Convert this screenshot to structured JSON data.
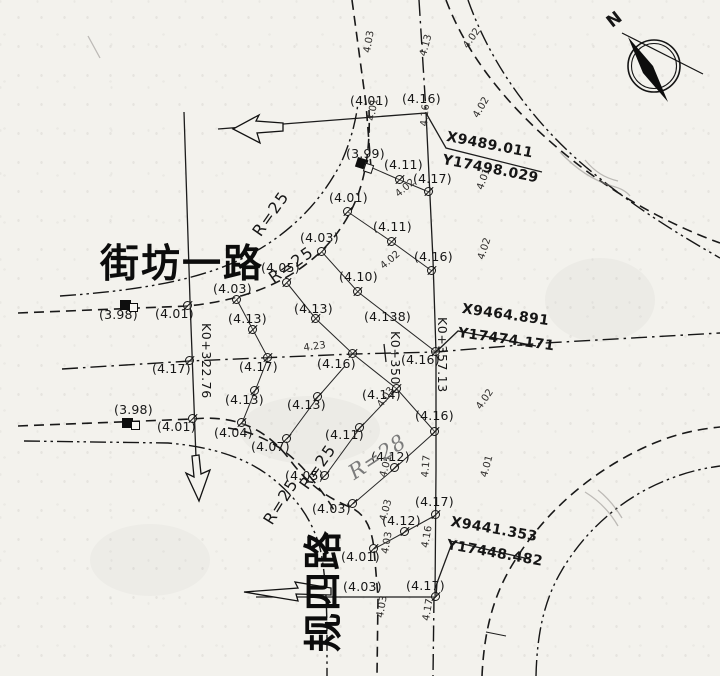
{
  "drawing": {
    "road_names": {
      "horizontal": "街坊一路",
      "vertical": "规四路"
    },
    "compass_label": "N",
    "coordinate_callouts": [
      {
        "x_label": "X9489.011",
        "y_label": "Y17498.029",
        "x": 448,
        "y": 130,
        "x2": 444,
        "y2": 153,
        "r": 11
      },
      {
        "x_label": "X9464.891",
        "y_label": "Y17474.171",
        "x": 463,
        "y": 302,
        "x2": 459,
        "y2": 326,
        "r": 8
      },
      {
        "x_label": "X9441.353",
        "y_label": "Y17448.482",
        "x": 452,
        "y": 515,
        "x2": 448,
        "y2": 538,
        "r": 10
      }
    ],
    "stations": [
      {
        "t": "K0+322.76",
        "x": 212,
        "y": 323,
        "r": 90
      },
      {
        "t": "K0+350",
        "x": 401,
        "y": 331,
        "r": 90
      },
      {
        "t": "K0+357.13",
        "x": 448,
        "y": 317,
        "r": 90
      }
    ],
    "radius_labels": [
      {
        "t": "R=25",
        "x": 250,
        "y": 230,
        "r": -55
      },
      {
        "t": "R=25",
        "x": 266,
        "y": 273,
        "r": -35
      },
      {
        "t": "R=25",
        "x": 297,
        "y": 483,
        "r": -55
      },
      {
        "t": "R=25",
        "x": 261,
        "y": 519,
        "r": -58
      }
    ],
    "pencil_note": {
      "t": "R=28",
      "x": 345,
      "y": 466,
      "r": -33
    },
    "spot_elevations": [
      {
        "t": "(4.01)",
        "x": 350,
        "y": 95
      },
      {
        "t": "(4.16)",
        "x": 402,
        "y": 93
      },
      {
        "t": "(3.99)",
        "x": 346,
        "y": 148
      },
      {
        "t": "(4.11)",
        "x": 384,
        "y": 159
      },
      {
        "t": "(4.17)",
        "x": 413,
        "y": 173
      },
      {
        "t": "(4.01)",
        "x": 329,
        "y": 192
      },
      {
        "t": "(4.11)",
        "x": 373,
        "y": 221
      },
      {
        "t": "(4.03)",
        "x": 300,
        "y": 232
      },
      {
        "t": "(4.16)",
        "x": 414,
        "y": 251
      },
      {
        "t": "(4.10)",
        "x": 339,
        "y": 271
      },
      {
        "t": "(4.05)",
        "x": 261,
        "y": 262
      },
      {
        "t": "(4.03)",
        "x": 213,
        "y": 283
      },
      {
        "t": "(3.98)",
        "x": 99,
        "y": 309
      },
      {
        "t": "(4.01)",
        "x": 155,
        "y": 308
      },
      {
        "t": "(4.13)",
        "x": 228,
        "y": 313
      },
      {
        "t": "(4.13)",
        "x": 294,
        "y": 303
      },
      {
        "t": "(4.138)",
        "x": 364,
        "y": 311
      },
      {
        "t": "(4.17)",
        "x": 152,
        "y": 363
      },
      {
        "t": "(4.17)",
        "x": 239,
        "y": 361
      },
      {
        "t": "(4.16)",
        "x": 317,
        "y": 358
      },
      {
        "t": "(4.16)",
        "x": 401,
        "y": 354
      },
      {
        "t": "(3.98)",
        "x": 114,
        "y": 404
      },
      {
        "t": "(4.01)",
        "x": 157,
        "y": 421
      },
      {
        "t": "(4.13)",
        "x": 225,
        "y": 394
      },
      {
        "t": "(4.13)",
        "x": 287,
        "y": 399
      },
      {
        "t": "(4.14)",
        "x": 362,
        "y": 389
      },
      {
        "t": "(4.04)",
        "x": 214,
        "y": 427
      },
      {
        "t": "(4.07)",
        "x": 251,
        "y": 441
      },
      {
        "t": "(4.11)",
        "x": 325,
        "y": 429
      },
      {
        "t": "(4.16)",
        "x": 415,
        "y": 410
      },
      {
        "t": "(4.05)",
        "x": 285,
        "y": 470
      },
      {
        "t": "(4.12)",
        "x": 371,
        "y": 451
      },
      {
        "t": "(4.12)",
        "x": 382,
        "y": 515
      },
      {
        "t": "(4.17)",
        "x": 415,
        "y": 496
      },
      {
        "t": "(4.03)",
        "x": 312,
        "y": 503
      },
      {
        "t": "(4.01)",
        "x": 341,
        "y": 551
      },
      {
        "t": "(4.03)",
        "x": 343,
        "y": 581
      },
      {
        "t": "(4.17)",
        "x": 406,
        "y": 580
      }
    ],
    "slope_labels": [
      {
        "t": "4.03",
        "x": 363,
        "y": 52,
        "r": -80
      },
      {
        "t": "4.13",
        "x": 419,
        "y": 55,
        "r": -75
      },
      {
        "t": "4.01",
        "x": 367,
        "y": 120,
        "r": -80
      },
      {
        "t": "4.16",
        "x": 420,
        "y": 126,
        "r": -85
      },
      {
        "t": "4.02",
        "x": 462,
        "y": 45,
        "r": -55
      },
      {
        "t": "4.02",
        "x": 472,
        "y": 115,
        "r": -60
      },
      {
        "t": "4.01",
        "x": 476,
        "y": 188,
        "r": -70
      },
      {
        "t": "4.02",
        "x": 394,
        "y": 192,
        "r": -40
      },
      {
        "t": "4.02",
        "x": 379,
        "y": 264,
        "r": -40
      },
      {
        "t": "4.02",
        "x": 477,
        "y": 258,
        "r": -72
      },
      {
        "t": "4.23",
        "x": 303,
        "y": 344,
        "r": -8
      },
      {
        "t": "4.03",
        "x": 376,
        "y": 404,
        "r": -55
      },
      {
        "t": "4.02",
        "x": 475,
        "y": 406,
        "r": -55
      },
      {
        "t": "4.01",
        "x": 379,
        "y": 476,
        "r": -75
      },
      {
        "t": "4.17",
        "x": 421,
        "y": 477,
        "r": -85
      },
      {
        "t": "4.01",
        "x": 480,
        "y": 476,
        "r": -75
      },
      {
        "t": "4.03",
        "x": 379,
        "y": 520,
        "r": -75
      },
      {
        "t": "4.03",
        "x": 381,
        "y": 553,
        "r": -80
      },
      {
        "t": "4.16",
        "x": 421,
        "y": 547,
        "r": -80
      },
      {
        "t": "4.03",
        "x": 376,
        "y": 617,
        "r": -80
      },
      {
        "t": "4.17",
        "x": 422,
        "y": 620,
        "r": -80
      }
    ],
    "survey_points": [
      [
        400,
        180
      ],
      [
        429,
        192
      ],
      [
        348,
        212
      ],
      [
        392,
        242
      ],
      [
        432,
        271
      ],
      [
        322,
        252
      ],
      [
        358,
        292
      ],
      [
        287,
        283
      ],
      [
        237,
        300
      ],
      [
        316,
        319
      ],
      [
        253,
        330
      ],
      [
        188,
        306
      ],
      [
        268,
        358
      ],
      [
        353,
        354
      ],
      [
        190,
        361
      ],
      [
        436,
        352
      ],
      [
        255,
        391
      ],
      [
        318,
        397
      ],
      [
        397,
        389
      ],
      [
        242,
        423
      ],
      [
        287,
        439
      ],
      [
        360,
        428
      ],
      [
        435,
        432
      ],
      [
        193,
        419
      ],
      [
        325,
        476
      ],
      [
        395,
        468
      ],
      [
        353,
        504
      ],
      [
        436,
        515
      ],
      [
        405,
        532
      ],
      [
        374,
        549
      ],
      [
        436,
        597
      ]
    ],
    "benchmarks": [
      {
        "x": 120,
        "y": 300,
        "r": 0
      },
      {
        "x": 358,
        "y": 157,
        "r": 18
      },
      {
        "x": 122,
        "y": 418,
        "r": 0
      }
    ]
  }
}
